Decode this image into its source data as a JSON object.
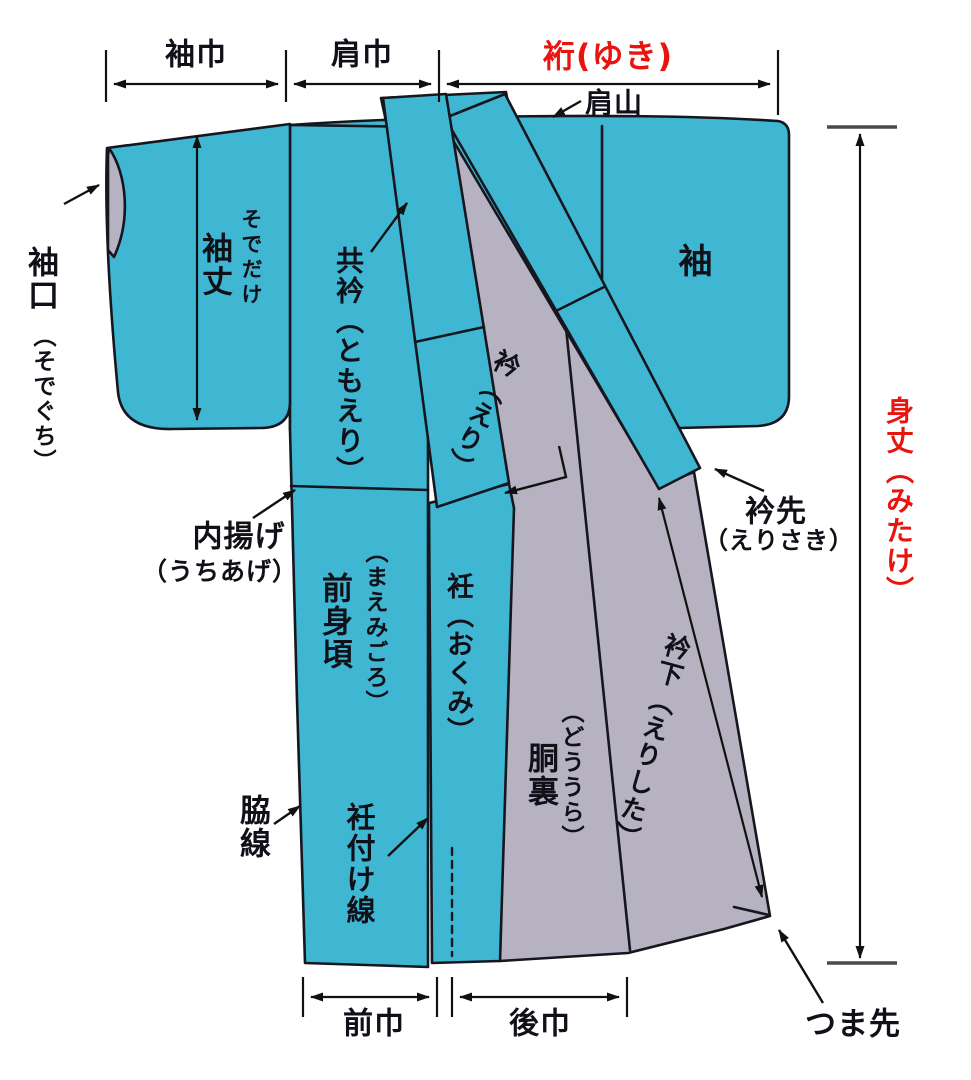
{
  "diagram": {
    "kind": "kimono-parts-diagram",
    "background": "#ffffff"
  },
  "colors": {
    "fabric_teal": "#3fb7d3",
    "lining_gray": "#b7b2c2",
    "outline": "#16161f",
    "accent_red": "#e81410",
    "dimension_black": "#111111",
    "dim_end_bar_gray": "#4a4a4a"
  },
  "labels": {
    "sode_haba": "袖巾",
    "kata_haba": "肩巾",
    "yuki": "裄(ゆき)",
    "katayama": "肩山",
    "sodeguchi_kanji": "袖口",
    "sodeguchi_kana": "（そでぐち）",
    "sodetake_kanji": "袖丈",
    "sodetake_kana": "そでだけ",
    "tomoeri": "共衿（ともえり）",
    "eri": "衿（えり）",
    "sode": "袖",
    "erisaki_kanji": "衿先",
    "erisaki_kana": "（えりさき）",
    "mitake": "身丈（みたけ）",
    "uchiage_kanji": "内揚げ",
    "uchiage_kana": "（うちあげ）",
    "maemigoro_kana": "（まえみごろ）",
    "maemigoro_kanji": "前身頃",
    "okumi": "衽（おくみ）",
    "doura_kana": "（どううら）",
    "doura_kanji": "胴裏",
    "erishita": "衿下（えりした）",
    "wakisen": "脇線",
    "okumitsuke_sen": "衽付け線",
    "mae_haba": "前巾",
    "ushiro_haba": "後巾",
    "tsumasaki": "つま先"
  }
}
